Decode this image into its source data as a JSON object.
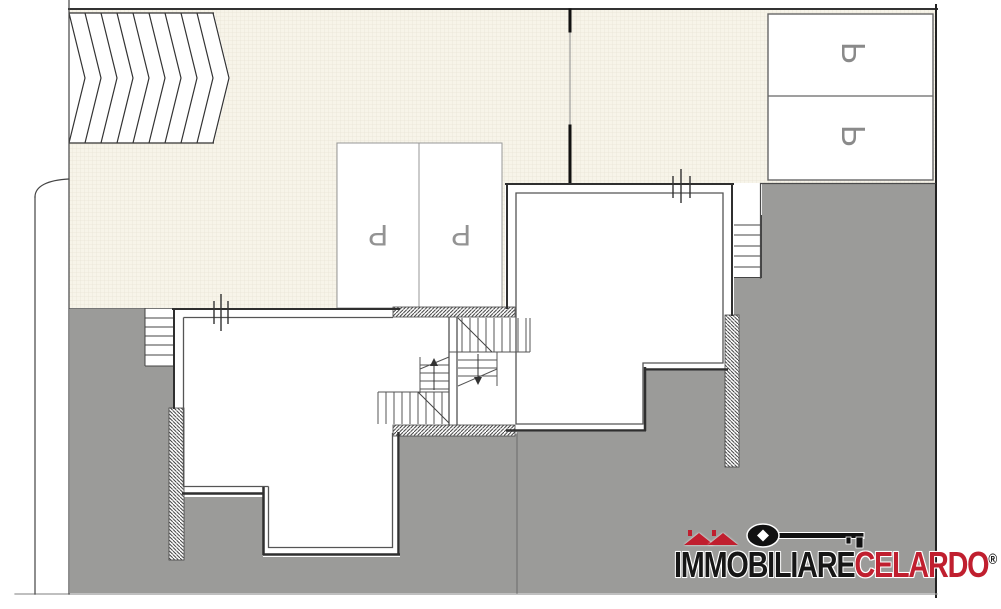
{
  "plan": {
    "parking_upper": {
      "spots": [
        {
          "label": "P"
        },
        {
          "label": "P"
        }
      ]
    },
    "parking_middle": {
      "spots": [
        {
          "label": "P"
        },
        {
          "label": "P"
        }
      ]
    }
  },
  "logo": {
    "name_black": "IMMOBILIARE",
    "name_red": "CELARDO",
    "registered": "®"
  },
  "colors": {
    "paper_cream": "#f7f4e9",
    "terrain_gray": "#9b9b99",
    "wall_dark": "#2f2f2f",
    "line_medium": "#555555",
    "parking_line": "#8f8f8f",
    "letter_gray": "#8a8a8a",
    "logo_red": "#c01f2f",
    "logo_black": "#161616"
  }
}
